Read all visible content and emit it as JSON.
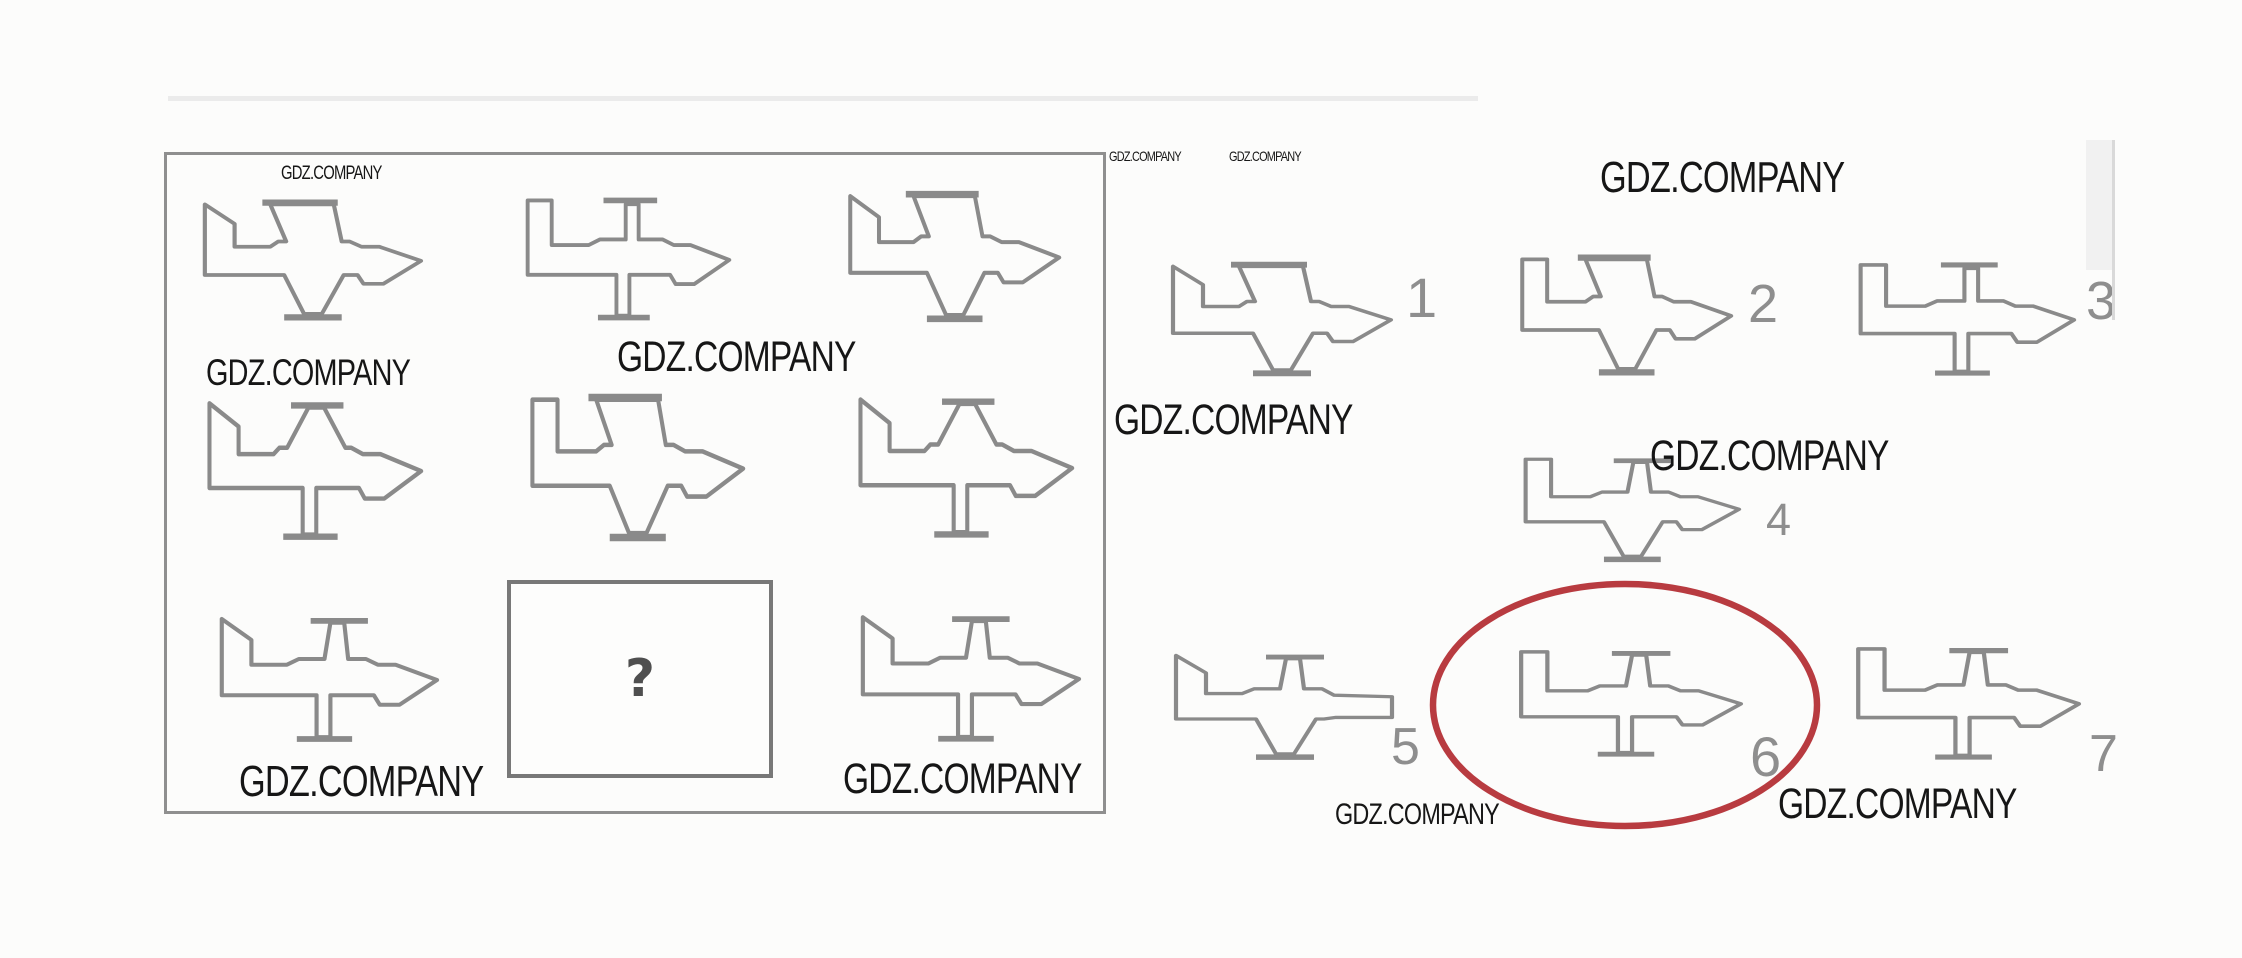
{
  "meta": {
    "description_watermark": "GDZ.COMPANY",
    "colors": {
      "line": "#8a8a8a",
      "frame": "#8f8f8f",
      "ink": "#161616",
      "number": "#8e8e8e",
      "accent_red": "#b83b40",
      "background": "#fcfcfb"
    }
  },
  "watermark": {
    "text": "GDZ.COMPANY",
    "instances": [
      {
        "x": 281,
        "y": 164,
        "fs": 19
      },
      {
        "x": 206,
        "y": 354,
        "fs": 37
      },
      {
        "x": 617,
        "y": 336,
        "fs": 43
      },
      {
        "x": 239,
        "y": 760,
        "fs": 44
      },
      {
        "x": 843,
        "y": 758,
        "fs": 43
      },
      {
        "x": 1109,
        "y": 149,
        "fs": 14
      },
      {
        "x": 1229,
        "y": 149,
        "fs": 14
      },
      {
        "x": 1600,
        "y": 156,
        "fs": 44
      },
      {
        "x": 1114,
        "y": 399,
        "fs": 43
      },
      {
        "x": 1650,
        "y": 435,
        "fs": 43
      },
      {
        "x": 1335,
        "y": 800,
        "fs": 30
      },
      {
        "x": 1778,
        "y": 783,
        "fs": 43
      }
    ]
  },
  "puzzle_grid": {
    "frame": {
      "x": 164,
      "y": 152,
      "w": 936,
      "h": 656
    },
    "missing_box": {
      "x": 507,
      "y": 580,
      "w": 266,
      "h": 198,
      "symbol": "?"
    },
    "planes": [
      {
        "id": "r1c1",
        "x": 187,
        "y": 185,
        "w": 238,
        "h": 150,
        "fin": "angled",
        "upper": "wide",
        "lower": "taper",
        "nose": "arrow"
      },
      {
        "id": "r1c2",
        "x": 511,
        "y": 180,
        "w": 222,
        "h": 158,
        "fin": "rect",
        "upper": "strut",
        "lower": "strut",
        "nose": "arrow"
      },
      {
        "id": "r1c3",
        "x": 833,
        "y": 175,
        "w": 230,
        "h": 163,
        "fin": "angled",
        "upper": "wide",
        "lower": "taper",
        "nose": "arrow"
      },
      {
        "id": "r2c1",
        "x": 192,
        "y": 380,
        "w": 233,
        "h": 180,
        "fin": "angled",
        "upper": "taper",
        "lower": "strut",
        "nose": "arrow"
      },
      {
        "id": "r2c2",
        "x": 515,
        "y": 376,
        "w": 232,
        "h": 183,
        "fin": "rect",
        "upper": "wide",
        "lower": "taper",
        "nose": "arrow"
      },
      {
        "id": "r2c3",
        "x": 843,
        "y": 376,
        "w": 233,
        "h": 182,
        "fin": "angled",
        "upper": "taper",
        "lower": "strut",
        "nose": "arrow"
      },
      {
        "id": "r3c1",
        "x": 204,
        "y": 598,
        "w": 237,
        "h": 162,
        "fin": "angled",
        "upper": "strutSlant",
        "lower": "strut",
        "nose": "arrow"
      },
      {
        "id": "r3c3",
        "x": 845,
        "y": 596,
        "w": 238,
        "h": 164,
        "fin": "angled",
        "upper": "strutSlant",
        "lower": "strut",
        "nose": "arrow"
      }
    ]
  },
  "options": [
    {
      "number": "1",
      "x": 1155,
      "y": 248,
      "w": 240,
      "h": 142,
      "fin": "angled",
      "upper": "wide",
      "lower": "taper",
      "nose": "arrow",
      "label_x": 1406,
      "label_y": 270,
      "label_fs": 56,
      "selected": false
    },
    {
      "number": "2",
      "x": 1505,
      "y": 240,
      "w": 230,
      "h": 150,
      "fin": "rect",
      "upper": "wide",
      "lower": "taper",
      "nose": "arrow",
      "label_x": 1748,
      "label_y": 277,
      "label_fs": 54,
      "selected": false
    },
    {
      "number": "3",
      "x": 1843,
      "y": 246,
      "w": 235,
      "h": 146,
      "fin": "rect",
      "upper": "strut",
      "lower": "strut",
      "nose": "arrow",
      "label_x": 2086,
      "label_y": 274,
      "label_fs": 54,
      "selected": false
    },
    {
      "number": "4",
      "x": 1508,
      "y": 442,
      "w": 235,
      "h": 133,
      "fin": "rect",
      "upper": "strutSlant",
      "lower": "taper",
      "nose": "arrow",
      "label_x": 1766,
      "label_y": 497,
      "label_fs": 45,
      "selected": false
    },
    {
      "number": "5",
      "x": 1158,
      "y": 638,
      "w": 240,
      "h": 135,
      "fin": "angled",
      "upper": "strutSlant",
      "lower": "taper",
      "nose": "flat",
      "label_x": 1391,
      "label_y": 721,
      "label_fs": 52,
      "selected": false
    },
    {
      "number": "6",
      "x": 1503,
      "y": 634,
      "w": 242,
      "h": 138,
      "fin": "rect",
      "upper": "strutSlant",
      "lower": "strut",
      "nose": "arrow",
      "label_x": 1750,
      "label_y": 729,
      "label_fs": 56,
      "selected": true
    },
    {
      "number": "7",
      "x": 1840,
      "y": 630,
      "w": 243,
      "h": 146,
      "fin": "rect",
      "upper": "strutSlant",
      "lower": "strut",
      "nose": "arrow",
      "label_x": 2089,
      "label_y": 728,
      "label_fs": 52,
      "selected": false
    }
  ],
  "answer_annotation": {
    "shape": "ellipse",
    "marks_option": "6",
    "cx": 1625,
    "cy": 705,
    "rx": 192,
    "ry": 121,
    "stroke": "#b83b40",
    "stroke_width": 6.5
  },
  "scan_artifacts": [
    {
      "x": 168,
      "y": 96,
      "w": 1310,
      "h": 5,
      "color": "#ebebeb"
    },
    {
      "x": 2086,
      "y": 140,
      "w": 28,
      "h": 130,
      "color": "#f1f1f1"
    },
    {
      "x": 2112,
      "y": 140,
      "w": 3,
      "h": 180,
      "color": "#d9d9d9"
    }
  ]
}
